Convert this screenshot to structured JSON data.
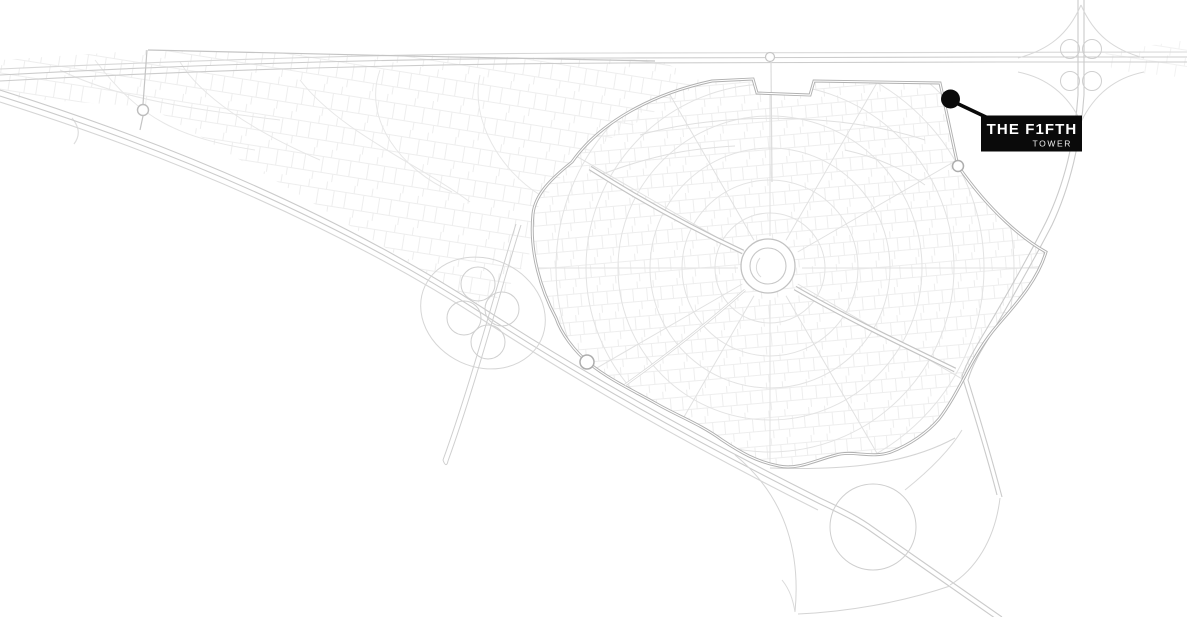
{
  "callout": {
    "title": "THE F1FTH",
    "subtitle": "TOWER",
    "background_color": "#0a0a0a",
    "text_color": "#ffffff",
    "subtitle_color": "#f2f2f2"
  },
  "marker": {
    "color": "#0a0a0a"
  },
  "map": {
    "background_color": "#ffffff",
    "parcel_line_color": "#ececec",
    "street_faint_color": "#e3e3e3",
    "highway_light_color": "#cccccc",
    "boundary_road_color": "#b0b0b0"
  }
}
